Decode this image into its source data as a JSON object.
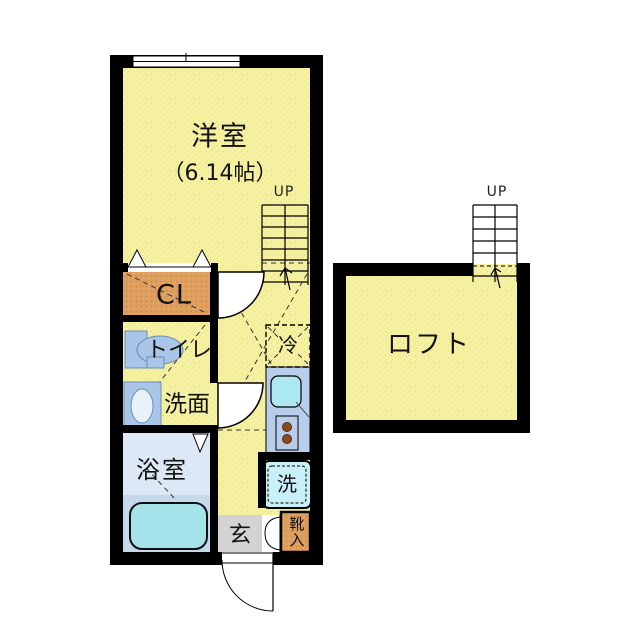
{
  "plan_title": "apartment-floor-plan",
  "rooms": {
    "main_room": {
      "label": "洋室",
      "size_label": "（6.14帖）"
    },
    "closet": {
      "label": "CL"
    },
    "toilet": {
      "label": "トイレ"
    },
    "washroom": {
      "label": "洗面"
    },
    "bathroom": {
      "label": "浴室"
    },
    "entrance": {
      "label": "玄"
    },
    "shoe_box": {
      "label": "靴入"
    },
    "refrigerator": {
      "label": "冷"
    },
    "washer": {
      "label": "洗"
    },
    "loft": {
      "label": "ロフト"
    }
  },
  "stairs": {
    "main_up_label": "UP",
    "loft_up_label": "UP"
  },
  "colors": {
    "floor_yellow": "#F6F1A1",
    "wall_black": "#000000",
    "closet_orange": "#DD9E5E",
    "fixture_blue": "#A9C6E8",
    "bath_floor_upper": "#DCE8F6",
    "bath_floor_lower": "#C6D8EC",
    "bathtub_cyan": "#A5E3EB",
    "kitchen_counter_blue": "#B7CDE9",
    "sink_cyan": "#ACE7F2",
    "washer_cyan": "#C9EFF7",
    "genkan_gray": "#D3D3D3",
    "burner_brown": "#8A4A20"
  }
}
